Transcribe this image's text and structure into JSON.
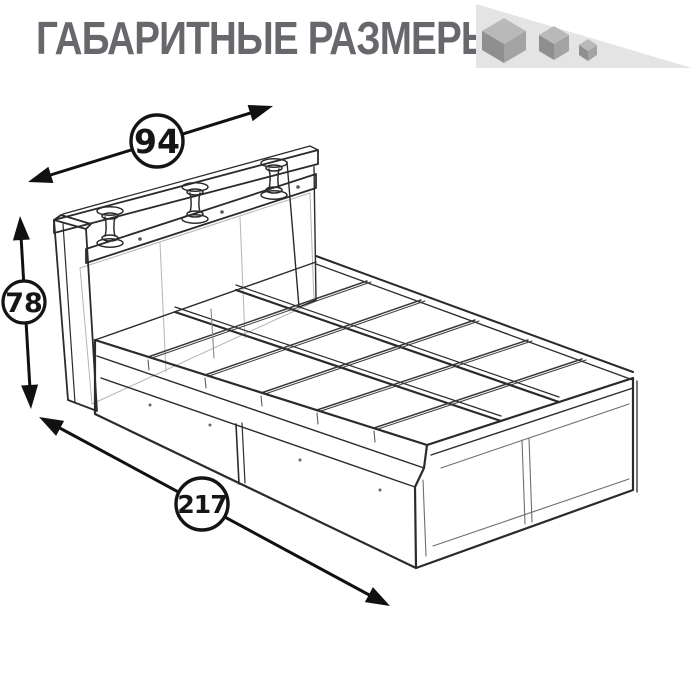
{
  "header": {
    "title": "ГАБАРИТНЫЕ РАЗМЕРЫ",
    "title_color": "#67686b"
  },
  "logo": {
    "icon": "shrinking-cubes-icon",
    "cubes_count": 3,
    "colors": {
      "triangle": "#e4e4e4",
      "cube_top": "#b9b9b9",
      "cube_left": "#8f8f8f",
      "cube_right": "#a3a3a3"
    }
  },
  "diagram": {
    "subject": "bed-frame-dimensional-drawing",
    "style": "black line art, perspective view, bed with headboard shelf on three spool posts and two underbed drawers",
    "line_color": "#2b2b2b",
    "dimensions": {
      "width": "94",
      "height": "78",
      "length": "217"
    }
  }
}
